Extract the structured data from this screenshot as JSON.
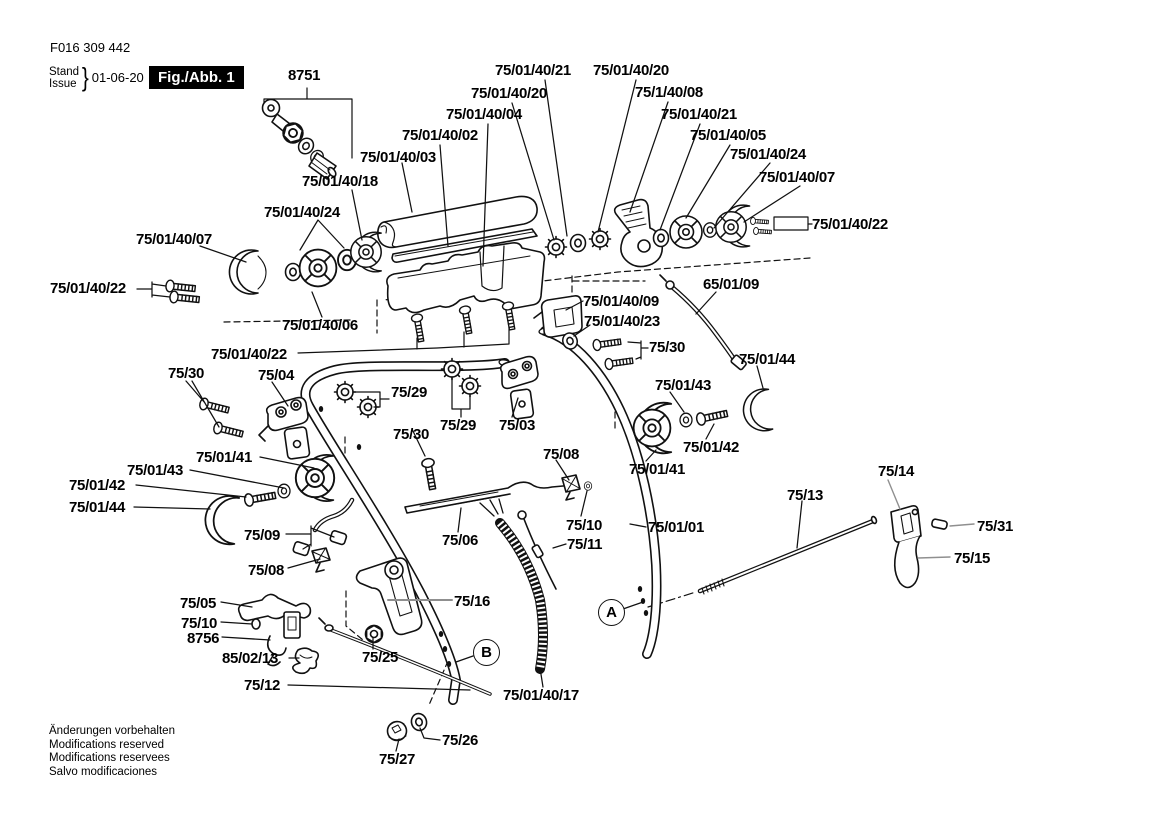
{
  "header": {
    "doc_number": "F016 309 442",
    "stand_label": "Stand",
    "issue_label": "Issue",
    "brace": "}",
    "date": "01-06-20",
    "figure_label": "Fig./Abb. 1"
  },
  "footer": {
    "line1": "Änderungen vorbehalten",
    "line2": "Modifications reserved",
    "line3": "Modifications reservees",
    "line4": "Salvo modificaciones"
  },
  "colors": {
    "ink": "#111111",
    "paper": "#ffffff",
    "leader_gray": "#8f8f8f",
    "badge_bg": "#000000",
    "badge_text": "#ffffff"
  },
  "markers": [
    {
      "letter": "A",
      "x": 598,
      "y": 599
    },
    {
      "letter": "B",
      "x": 473,
      "y": 639
    }
  ],
  "part_labels": [
    {
      "text": "8751",
      "x": 288,
      "y": 68
    },
    {
      "text": "75/01/40/21",
      "x": 495,
      "y": 63
    },
    {
      "text": "75/01/40/20",
      "x": 593,
      "y": 63
    },
    {
      "text": "75/01/40/20",
      "x": 471,
      "y": 86
    },
    {
      "text": "75/1/40/08",
      "x": 635,
      "y": 85
    },
    {
      "text": "75/01/40/04",
      "x": 446,
      "y": 107
    },
    {
      "text": "75/01/40/21",
      "x": 661,
      "y": 107
    },
    {
      "text": "75/01/40/02",
      "x": 402,
      "y": 128
    },
    {
      "text": "75/01/40/05",
      "x": 690,
      "y": 128
    },
    {
      "text": "75/01/40/03",
      "x": 360,
      "y": 150
    },
    {
      "text": "75/01/40/24",
      "x": 730,
      "y": 147
    },
    {
      "text": "75/01/40/18",
      "x": 302,
      "y": 174
    },
    {
      "text": "75/01/40/07",
      "x": 759,
      "y": 170
    },
    {
      "text": "75/01/40/24",
      "x": 264,
      "y": 205
    },
    {
      "text": "75/01/40/22",
      "x": 812,
      "y": 217
    },
    {
      "text": "75/01/40/07",
      "x": 136,
      "y": 232
    },
    {
      "text": "75/01/40/22",
      "x": 50,
      "y": 281
    },
    {
      "text": "65/01/09",
      "x": 703,
      "y": 277
    },
    {
      "text": "75/01/40/09",
      "x": 583,
      "y": 294
    },
    {
      "text": "75/01/40/23",
      "x": 584,
      "y": 314
    },
    {
      "text": "75/30",
      "x": 649,
      "y": 340
    },
    {
      "text": "75/01/40/06",
      "x": 282,
      "y": 318
    },
    {
      "text": "75/01/44",
      "x": 739,
      "y": 352
    },
    {
      "text": "75/01/40/22",
      "x": 211,
      "y": 347
    },
    {
      "text": "75/30",
      "x": 168,
      "y": 366
    },
    {
      "text": "75/04",
      "x": 258,
      "y": 368
    },
    {
      "text": "75/29",
      "x": 391,
      "y": 385
    },
    {
      "text": "75/01/43",
      "x": 655,
      "y": 378
    },
    {
      "text": "75/29",
      "x": 440,
      "y": 418
    },
    {
      "text": "75/03",
      "x": 499,
      "y": 418
    },
    {
      "text": "75/30",
      "x": 393,
      "y": 427
    },
    {
      "text": "75/08",
      "x": 543,
      "y": 447
    },
    {
      "text": "75/01/42",
      "x": 683,
      "y": 440
    },
    {
      "text": "75/01/41",
      "x": 196,
      "y": 450
    },
    {
      "text": "75/01/43",
      "x": 127,
      "y": 463
    },
    {
      "text": "75/01/41",
      "x": 629,
      "y": 462
    },
    {
      "text": "75/14",
      "x": 878,
      "y": 464
    },
    {
      "text": "75/01/42",
      "x": 69,
      "y": 478
    },
    {
      "text": "75/13",
      "x": 787,
      "y": 488
    },
    {
      "text": "75/01/44",
      "x": 69,
      "y": 500
    },
    {
      "text": "75/31",
      "x": 977,
      "y": 519
    },
    {
      "text": "75/09",
      "x": 244,
      "y": 528
    },
    {
      "text": "75/10",
      "x": 566,
      "y": 518
    },
    {
      "text": "75/01/01",
      "x": 648,
      "y": 520
    },
    {
      "text": "75/06",
      "x": 442,
      "y": 533
    },
    {
      "text": "75/11",
      "x": 567,
      "y": 537
    },
    {
      "text": "75/15",
      "x": 954,
      "y": 551
    },
    {
      "text": "75/08",
      "x": 248,
      "y": 563
    },
    {
      "text": "75/16",
      "x": 454,
      "y": 594
    },
    {
      "text": "75/05",
      "x": 180,
      "y": 596
    },
    {
      "text": "75/10",
      "x": 181,
      "y": 616
    },
    {
      "text": "8756",
      "x": 187,
      "y": 631
    },
    {
      "text": "85/02/13",
      "x": 222,
      "y": 651
    },
    {
      "text": "75/25",
      "x": 362,
      "y": 650
    },
    {
      "text": "75/12",
      "x": 244,
      "y": 678
    },
    {
      "text": "75/01/40/17",
      "x": 503,
      "y": 688
    },
    {
      "text": "75/26",
      "x": 442,
      "y": 733
    },
    {
      "text": "75/27",
      "x": 379,
      "y": 752
    }
  ]
}
